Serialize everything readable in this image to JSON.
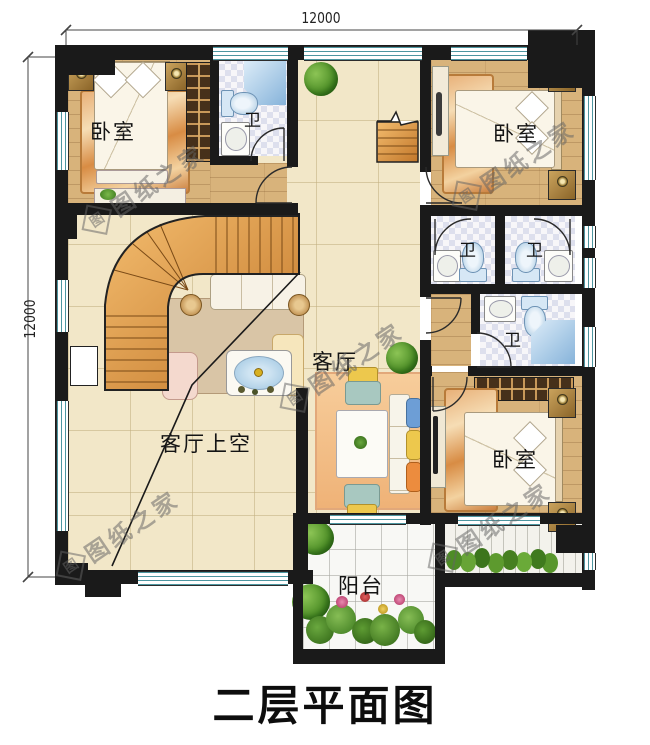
{
  "plan": {
    "title": "二层平面图",
    "dim_top": "12000",
    "dim_left": "12000",
    "watermark_text": "图纸之家",
    "watermark_logo": "图",
    "labels": {
      "bedroom_tl": "卧室",
      "bedroom_tr": "卧室",
      "bedroom_br": "卧室",
      "bath_tl": "卫",
      "bath_mid_left": "卫",
      "bath_mid_right": "卫",
      "bath_lower": "卫",
      "living": "客厅",
      "living_void": "客厅上空",
      "balcony": "阳台"
    },
    "colors": {
      "wall": "#1a1a1a",
      "wood_floor": "#d8b37b",
      "tile_beige": "#f2e7c8",
      "stair_wood": "#d98a3c",
      "fixture_blue": "#9fc3de",
      "window_line": "#4d96a0"
    }
  }
}
